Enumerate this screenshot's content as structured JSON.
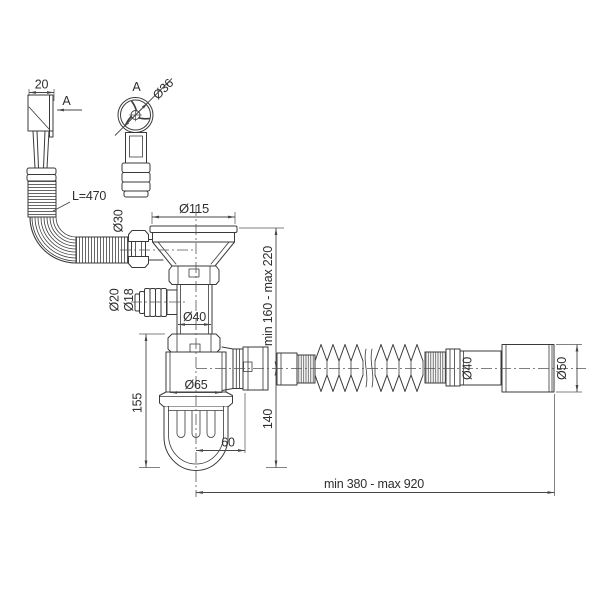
{
  "title": "Sink waste siphon with overflow — dimensioned technical drawing",
  "colors": {
    "line": "#3a3a3a",
    "text": "#2e2e2e",
    "background": "#ffffff"
  },
  "labels": {
    "overflow_width": "20",
    "section_arrow": "A",
    "detail_title": "A",
    "overflow_cap_diameter": "Ø36",
    "overflow_hose_length": "L=470",
    "overflow_nut_diameter": "Ø30",
    "strainer_flange_diameter": "Ø115",
    "appliance_inlet_outer_diameter": "Ø20",
    "appliance_inlet_inner_diameter": "Ø18",
    "body_pipe_diameter": "Ø40",
    "inlet_height_range": "min 160 - max 220",
    "trap_height": "155",
    "trap_cup_diameter": "Ø65",
    "outlet_offset": "60",
    "outlet_drop_height": "140",
    "outlet_hose_diameter": "Ø40",
    "outlet_end_diameter": "Ø50",
    "overall_length_range": "min 380 - max 920"
  }
}
